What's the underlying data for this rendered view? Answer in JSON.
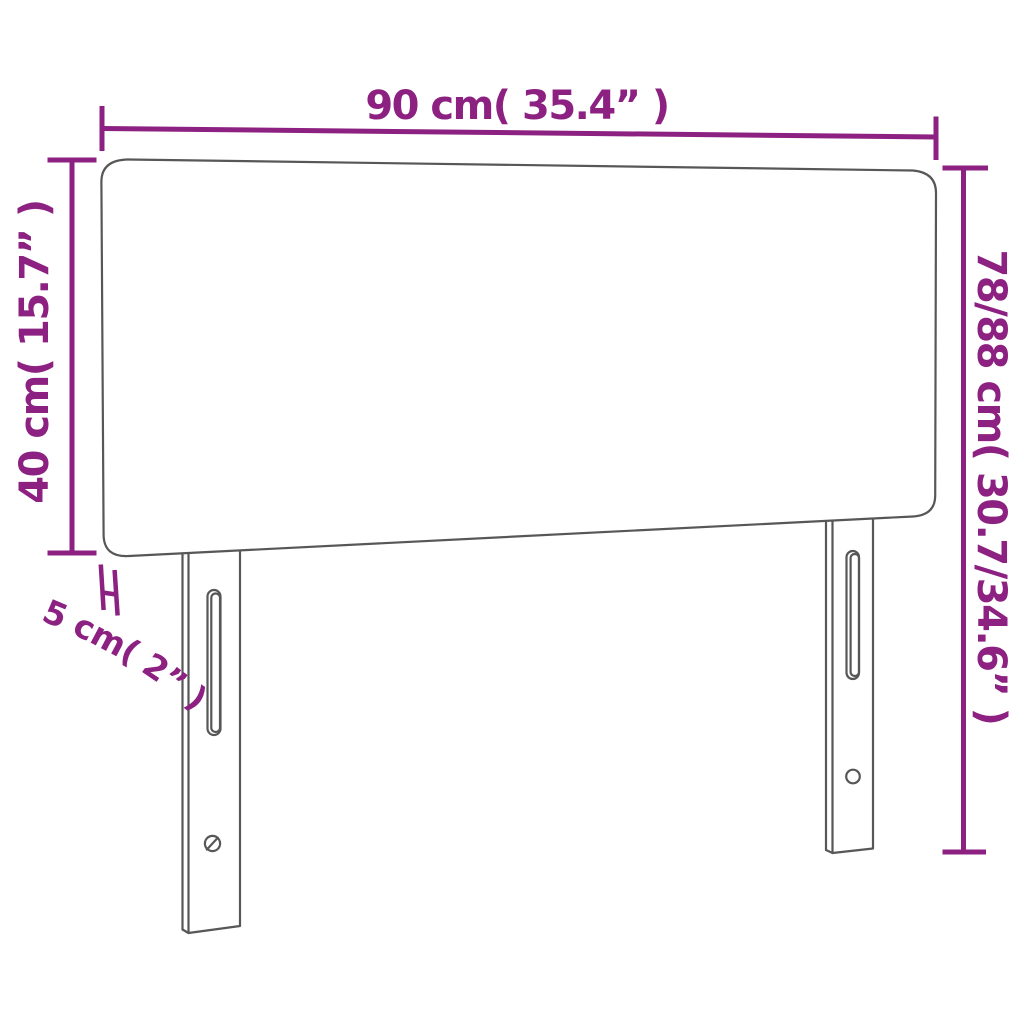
{
  "diagram": {
    "type": "furniture-dimension-diagram",
    "subject": "headboard with two mounting legs",
    "colors": {
      "dimension": "#8C2181",
      "outline": "#575757",
      "background": "#FFFFFF"
    },
    "dimensions": {
      "width": {
        "label": "90 cm( 35.4” )",
        "value_cm": "90",
        "value_in": "35.4"
      },
      "panel_height": {
        "label": "40 cm( 15.7” )",
        "value_cm": "40",
        "value_in": "15.7"
      },
      "total_height": {
        "label": "78/88 cm( 30.7/34.6” )",
        "value_cm": "78/88",
        "value_in": "30.7/34.6"
      },
      "thickness": {
        "label": "5 cm( 2” )",
        "value_cm": "5",
        "value_in": "2"
      }
    }
  }
}
